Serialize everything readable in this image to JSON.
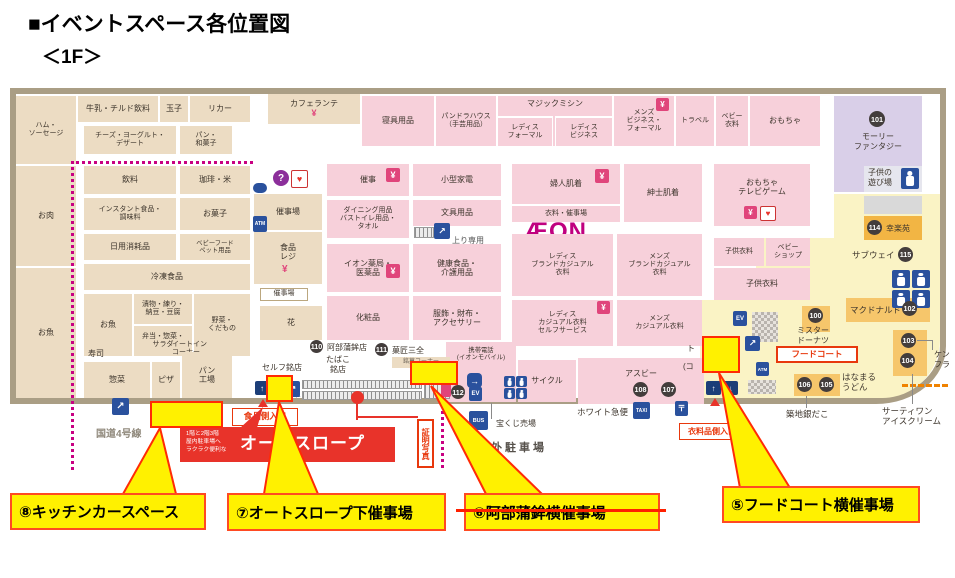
{
  "header": {
    "title": "■イベントスペース各位置図",
    "floor": "＜1F＞"
  },
  "icons": {
    "yen": "¥",
    "question": "?",
    "heart": "♥",
    "escalator": "↗",
    "up": "↑",
    "down": "↓",
    "turn": "→",
    "ev": "EV",
    "atm": "ATM",
    "bus": "BUS",
    "taxi": "TAXI",
    "post": "〒",
    "arrow_left": "←",
    "arrow_right": "→"
  },
  "food": {
    "ham": "ハム・\nソーセージ",
    "meat": "お肉",
    "fish_big": "お魚",
    "milk": "牛乳・チルド飲料",
    "eggs": "玉子",
    "liquor": "リカー",
    "cheese": "チーズ・ヨーグルト・\nデザート",
    "bread": "パン・\n和菓子",
    "caferante": "カフェランテ",
    "drinks": "飲料",
    "coffee_rice": "珈琲・米",
    "instant": "インスタント食品・\n調味料",
    "snacks": "お菓子",
    "daily": "日用消耗品",
    "babyfood": "ベビーフード\nペット用品",
    "frozen": "冷凍食品",
    "fish_small": "お魚",
    "pickles": "漬物・練り・\n納豆・豆腐",
    "bento": "弁当・惣菜・\nサラダ",
    "veg": "野菜・\nくだもの",
    "sushi": "寿司",
    "eatin": "イートイン\nコーナー",
    "deli": "惣菜",
    "pizza": "ピザ",
    "bakery": "パン\n工場",
    "event_hall": "催事場",
    "register": "食品\nレジ",
    "event_hall2": "催事場",
    "flower": "花"
  },
  "center": {
    "event": "催事",
    "small_elec": "小型家電",
    "dining": "ダイニング用品\nバストイレ用品・\nタオル",
    "stationery": "文具用品",
    "up_only": "上り専用",
    "pharmacy": "イオン薬局・\n医薬品",
    "health": "健康食品・\n介護用品",
    "cosmetics": "化粧品",
    "accessory": "服飾・財布・\nアクセサリー"
  },
  "clothing": {
    "bedding": "寝具用品",
    "pandora": "パンドラハウス\n（手芸用品）",
    "magic": "マジックミシン",
    "ladies_formal": "レディス\nフォーマル",
    "ladies_business": "レディス\nビジネス",
    "mens_bf": "メンズ\nビジネス・\nフォーマル",
    "travel": "トラベル",
    "baby": "ベビー\n衣料",
    "toys": "おもちゃ",
    "fujin": "婦人肌着",
    "iryo_event": "衣料・催事場",
    "shinshi": "紳士肌着",
    "aeon": "ÆON",
    "ladies_brand": "レディス\nブランドカジュアル\n衣料",
    "mens_brand": "メンズ\nブランドカジュアル\n衣料",
    "ladies_casual": "レディス\nカジュアル衣料\nセルフサービス",
    "mens_casual": "メンズ\nカジュアル衣料",
    "toys_tv": "おもちゃ\nテレビゲーム",
    "kids1": "子供衣料",
    "babyshop": "ベビー\nショップ",
    "kids2": "子供衣料"
  },
  "right": {
    "molly": "モーリー\nファンタジー",
    "playground": "子供の\n遊び場",
    "kouraku": "幸楽苑",
    "subway": "サブウェイ",
    "mcdonalds": "マクドナルド",
    "misdo": "ミスター\nドーナツ",
    "foodcourt": "フードコート",
    "hanamaru": "はなまる\nうどん",
    "tsukiji": "築地銀だこ",
    "ice31": "サーティワン\nアイスクリーム",
    "kfc_clipped": "ケン\nフラ"
  },
  "south": {
    "self_meiten": "セルフ銘店",
    "abekama": "阿部蒲鉾店",
    "tabaco": "たばこ\n銘店",
    "sanzen": "菓匠三全",
    "meika": "銘菓コーナー",
    "mobile": "携帯電話\n(イオンモバイル)",
    "cycle": "サイクル",
    "asbee": "アスビー",
    "lottery": "宝くじ売場",
    "white_kyubin": "ホワイト急便",
    "okugai": "屋外駐車場",
    "kokudo": "国道4号線",
    "shomei": "証明写真",
    "iryo_in": "衣料品側入口",
    "food_in": "食品側入口",
    "slope_small": "1階と2階3階\n屋内駐車場へ\nラクラク便利な",
    "slope_big": "オートスロープ",
    "to_frag": "ト",
    "ko_frag": "(コ"
  },
  "callouts": {
    "c5": "⑤フードコート横催事場",
    "c6": "⑥阿部蒲鉾横催事場",
    "c7": "⑦オートスロープ下催事場",
    "c8": "⑧キッチンカースペース"
  },
  "nums": {
    "n100": "100",
    "n101": "101",
    "n102": "102",
    "n103": "103",
    "n104": "104",
    "n105": "105",
    "n106": "106",
    "n107": "107",
    "n108": "108",
    "n110": "110",
    "n111": "111",
    "n112": "112",
    "n114": "114",
    "n115": "115"
  }
}
